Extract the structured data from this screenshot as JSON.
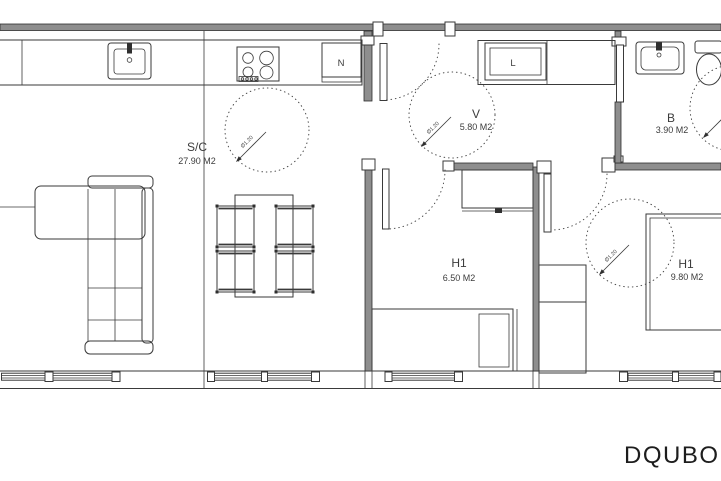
{
  "plan": {
    "rooms": [
      {
        "code": "S/C",
        "area": "27.90 M2"
      },
      {
        "code": "V",
        "area": "5.80 M2"
      },
      {
        "code": "B",
        "area": "3.90 M2"
      },
      {
        "code": "H1",
        "area": "6.50 M2"
      },
      {
        "code": "H1",
        "area": "9.80 M2"
      }
    ],
    "appliances": {
      "fridge": "N",
      "washer": "L"
    },
    "turning_circle_label": "Ø1.20",
    "brand": "DQUBO",
    "colors": {
      "line": "#3a3a3a",
      "wall": "#8e8e8e"
    }
  }
}
